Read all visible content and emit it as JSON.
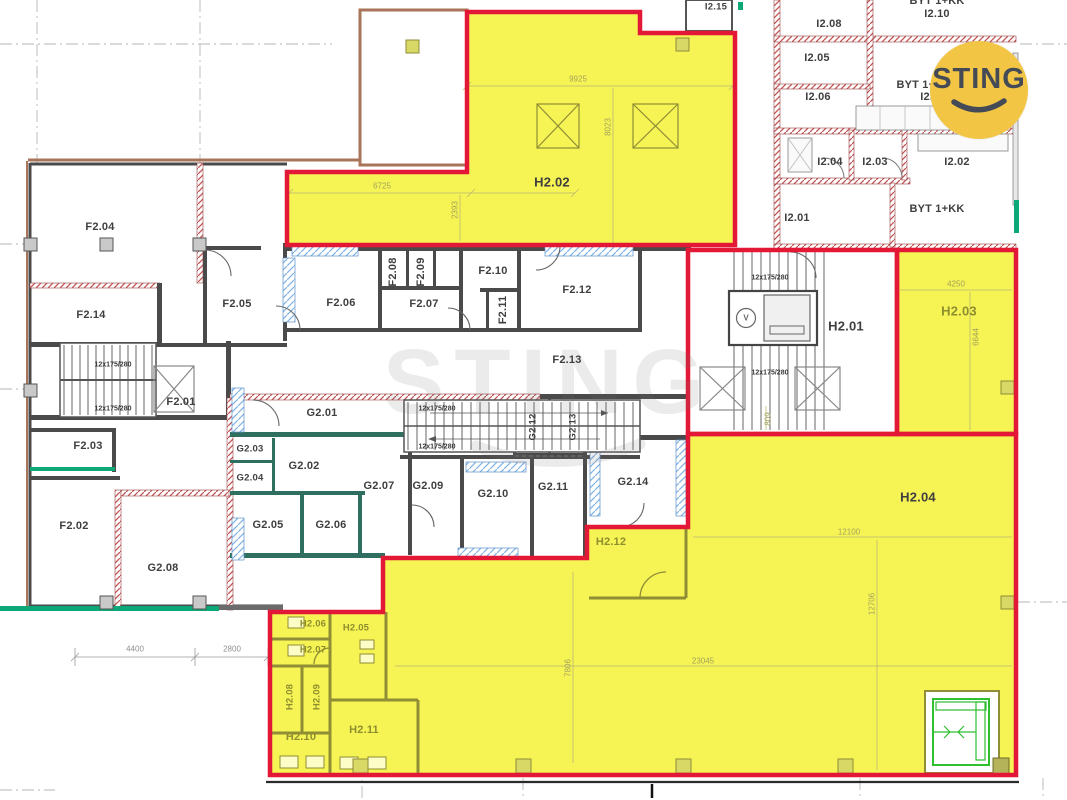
{
  "logo": {
    "text": "STING",
    "bg_color": "#F2C544",
    "text_color": "#454A57"
  },
  "watermark": {
    "text": "STING"
  },
  "colors": {
    "highlight_yellow": "#F6F355",
    "boundary_red": "#E31837",
    "olive_wall": "#8f8d35",
    "teal_accent": "#0ca877",
    "wall_dark": "#4a4a4a"
  },
  "rooms": {
    "f201": "F2.01",
    "f202": "F2.02",
    "f203": "F2.03",
    "f204": "F2.04",
    "f205": "F2.05",
    "f206": "F2.06",
    "f207": "F2.07",
    "f208": "F2.08",
    "f209": "F2.09",
    "f210": "F2.10",
    "f211": "F2.11",
    "f212": "F2.12",
    "f213": "F2.13",
    "f214": "F2.14",
    "g201": "G2.01",
    "g202": "G2.02",
    "g203": "G2.03",
    "g204": "G2.04",
    "g205": "G2.05",
    "g206": "G2.06",
    "g207": "G2.07",
    "g208": "G2.08",
    "g209": "G2.09",
    "g210": "G2.10",
    "g211": "G2.11",
    "g212": "G2.12",
    "g213": "G2.13",
    "g214": "G2.14",
    "h201": "H2.01",
    "h202": "H2.02",
    "h203": "H2.03",
    "h204": "H2.04",
    "h205": "H2.05",
    "h206": "H2.06",
    "h207": "H2.07",
    "h208": "H2.08",
    "h209": "H2.09",
    "h210": "H2.10",
    "h211": "H2.11",
    "h212": "H2.12",
    "i201": "I2.01",
    "i202": "I2.02",
    "i203": "I2.03",
    "i204": "I2.04",
    "i205": "I2.05",
    "i206": "I2.06",
    "i207": "I2.07",
    "i208": "I2.08",
    "i210": "I2.10",
    "i215": "I2.15",
    "byt": "BYT 1+KK"
  },
  "dims": {
    "d9925": "9925",
    "d8023": "8023",
    "d6725": "6725",
    "d2393": "2393",
    "d4250": "4250",
    "d6644": "6644",
    "d809": "809",
    "d12100": "12100",
    "d12706": "12706",
    "d23045": "23045",
    "d7806": "7806",
    "d4400": "4400",
    "d2800": "2800",
    "stair_note": "12x175/280",
    "elevator_mark": "V"
  }
}
